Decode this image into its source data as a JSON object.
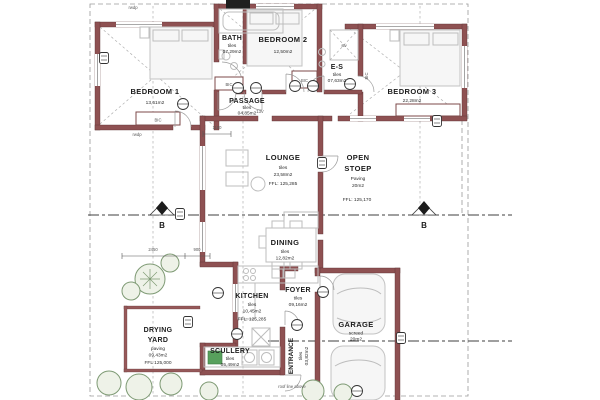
{
  "rooms": [
    {
      "name": "BEDROOM 1",
      "area": "13,61m2"
    },
    {
      "name": "BEDROOM 2",
      "area": "12,50m2"
    },
    {
      "name": "BEDROOM 3",
      "area": "22,28m2"
    },
    {
      "name": "BATH",
      "finish": "tiles",
      "area": "07,29m2"
    },
    {
      "name": "E-S",
      "finish": "tiles",
      "area": "07,63m2"
    },
    {
      "name": "PASSAGE",
      "finish": "tiles",
      "area": "04,85m2"
    },
    {
      "name": "LOUNGE",
      "finish": "tiles",
      "area": "23,58m2",
      "ffl": "FFL: 125,285"
    },
    {
      "name1": "OPEN",
      "name2": "STOEP",
      "finish": "Paving",
      "area": "20m2",
      "ffl": "FFL: 125,170"
    },
    {
      "name": "DINING",
      "finish": "tiles",
      "area": "12,82m2"
    },
    {
      "name": "KITCHEN",
      "finish": "tiles",
      "area": "10,45m2",
      "ffl": "FFL: 125,285"
    },
    {
      "name": "FOYER",
      "finish": "tiles",
      "area": "09,16m2"
    },
    {
      "name": "GARAGE",
      "finish": "screed",
      "area": "20m2"
    },
    {
      "name1": "DRYING",
      "name2": "YARD",
      "finish": "paving",
      "area": "09,43m2",
      "ffl": "FFL 125,000"
    },
    {
      "name": "SCULLERY",
      "finish": "tiles",
      "area": "05,49m2"
    },
    {
      "name": "ENTRANCE",
      "finish": "tiles",
      "area": "03,82m2"
    }
  ],
  "annotations": {
    "section_marker": "B",
    "closet": "BIC",
    "shower": "stv",
    "dim_a": "1100",
    "dim_b": "2450",
    "dim_c": "900",
    "grid_note": "13V",
    "downpipe": "rwdp",
    "roof_note": "roof line above"
  },
  "colors": {
    "wall": "#8e5152",
    "section_line": "#3f3f3f",
    "greenery": "#7e9a74"
  }
}
